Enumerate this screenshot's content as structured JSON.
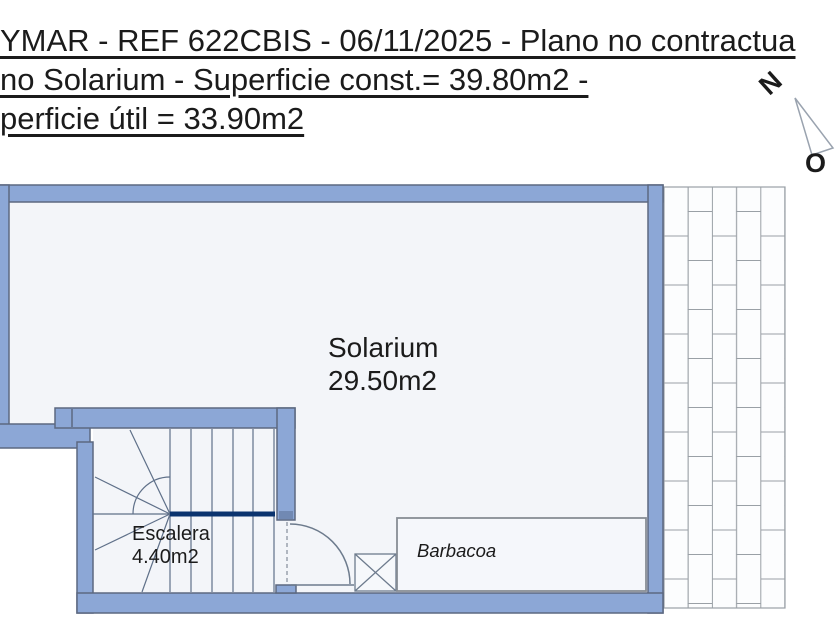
{
  "header": {
    "line1": "YMAR - REF 622CBIS - 06/11/2025 - Plano no contractua",
    "line2": "no Solarium - Superficie const.= 39.80m2 -",
    "line3": "perficie útil = 33.90m2"
  },
  "compass": {
    "north_label": "N",
    "west_label": "O"
  },
  "rooms": {
    "solarium": {
      "label": "Solarium",
      "area": "29.50m2"
    },
    "escalera": {
      "label": "Escalera",
      "area": "4.40m2"
    },
    "barbacoa": {
      "label": "Barbacoa"
    }
  },
  "colors": {
    "wall_fill": "#8ca7d6",
    "wall_outline": "#5c6880",
    "interior_fill": "#f3f5f9",
    "stair_line": "#5f7089",
    "stair_divider_navy": "#0a336e",
    "brick_line": "#9aa0a6",
    "background": "#ffffff",
    "text": "#1b1b1b"
  }
}
